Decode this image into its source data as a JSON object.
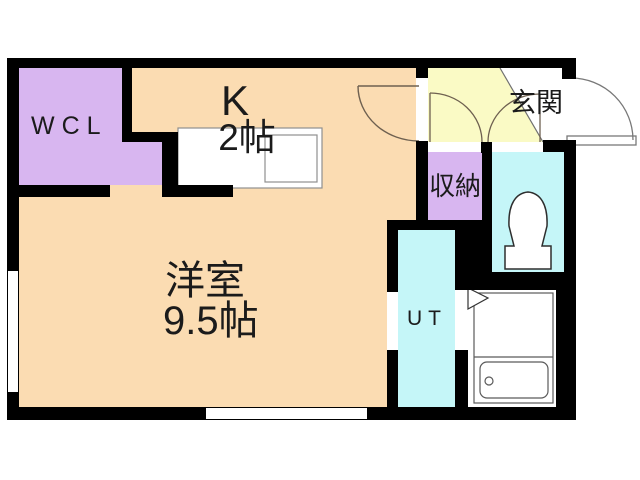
{
  "plan": {
    "title": "1R apartment floor plan",
    "rooms": {
      "wcl": {
        "label": "WCL"
      },
      "kitchen": {
        "label": "K",
        "size": "2帖"
      },
      "living": {
        "label": "洋室",
        "size": "9.5帖"
      },
      "entrance": {
        "label": "玄関"
      },
      "storage": {
        "label": "収納"
      },
      "utility": {
        "label": "UT"
      }
    },
    "fixtures": [
      "kitchen-sink",
      "toilet",
      "bathtub"
    ],
    "colors": {
      "c-room": "#FBDCB2",
      "c-closet": "#D8B6F0",
      "c-hall": "#FAFAC5",
      "c-wet": "#C5F6F8",
      "c-wall": "#000000",
      "c-arc": "#6E6050",
      "c-fixture": "#4F4F4F"
    }
  }
}
